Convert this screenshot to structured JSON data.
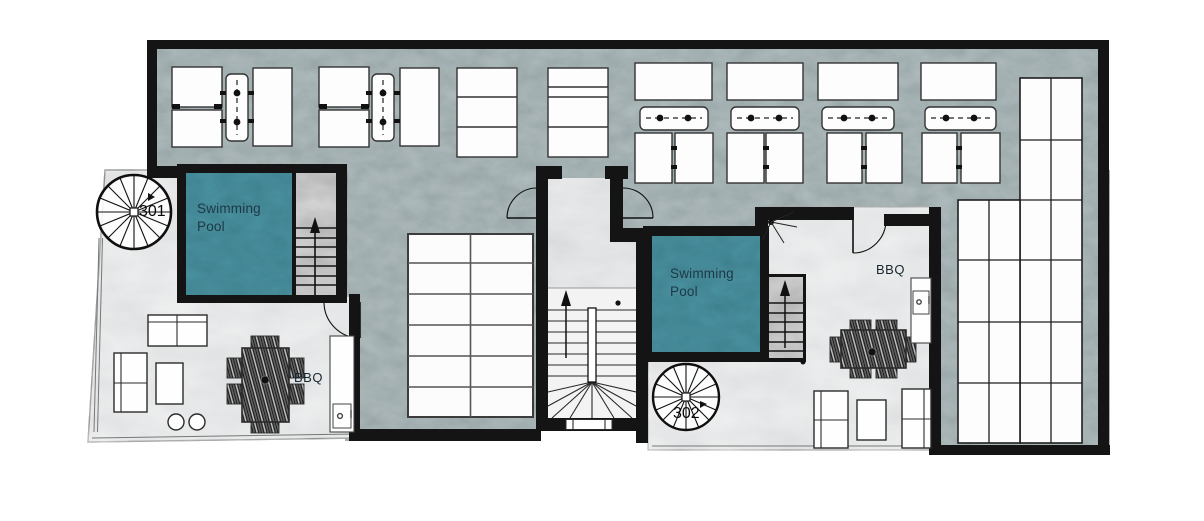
{
  "plan": {
    "type": "floor-plan",
    "units": [
      {
        "number": "301",
        "pool_label": "Swimming Pool",
        "bbq_label": "BBQ"
      },
      {
        "number": "302",
        "pool_label": "Swimming Pool",
        "bbq_label": "BBQ"
      }
    ],
    "colors": {
      "pool": "#4d96a6",
      "concrete_deck": "#b6c2c4",
      "terrace_floor": "#d8dadb",
      "walls": "#141414",
      "stair_fill": "#989898"
    }
  }
}
